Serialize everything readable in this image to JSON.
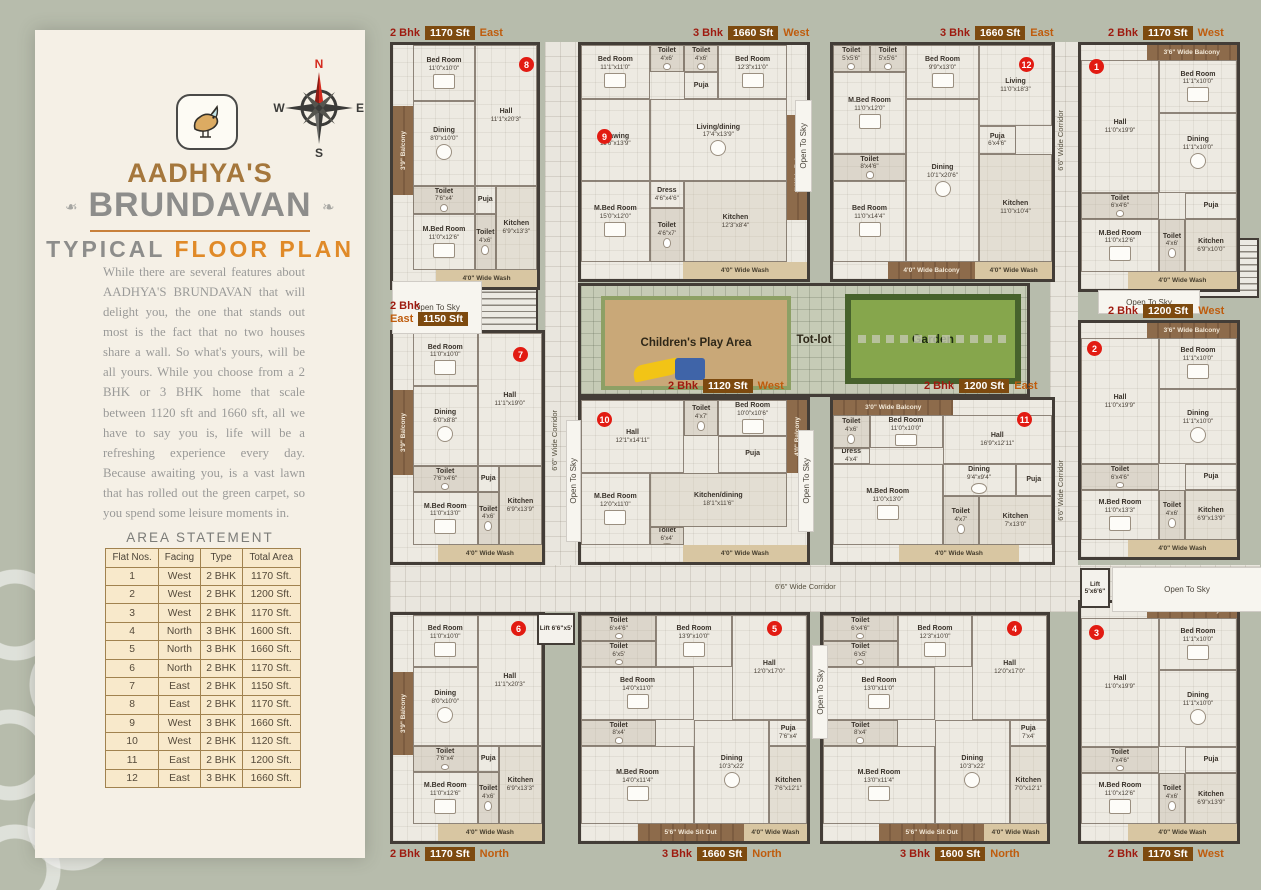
{
  "sidebar": {
    "brand_top": "AADHYA'S",
    "brand_main": "BRUNDAVAN",
    "subtitle_gray": "TYPICAL ",
    "subtitle_orange": "FLOOR PLAN",
    "paragraph": "While there are several features about AADHYA'S BRUNDAVAN that will delight you, the one that stands out most is the fact that no two houses share a wall. So what's yours, will be all yours. While you choose from a 2 BHK or 3 BHK home that scale between 1120 sft and 1660 sft, all we have to say you is, life will be a refreshing experience every day. Because awaiting you, is a vast lawn that has rolled out the green carpet, so you spend some leisure moments in.",
    "compass": {
      "n": "N",
      "e": "E",
      "s": "S",
      "w": "W"
    },
    "area_statement": {
      "title": "AREA STATEMENT",
      "headers": [
        "Flat Nos.",
        "Facing",
        "Type",
        "Total Area"
      ],
      "rows": [
        [
          "1",
          "West",
          "2 BHK",
          "1170 Sft."
        ],
        [
          "2",
          "West",
          "2 BHK",
          "1200 Sft."
        ],
        [
          "3",
          "West",
          "2 BHK",
          "1170 Sft."
        ],
        [
          "4",
          "North",
          "3 BHK",
          "1600 Sft."
        ],
        [
          "5",
          "North",
          "3 BHK",
          "1660 Sft."
        ],
        [
          "6",
          "North",
          "2 BHK",
          "1170 Sft."
        ],
        [
          "7",
          "East",
          "2 BHK",
          "1150 Sft."
        ],
        [
          "8",
          "East",
          "2 BHK",
          "1170 Sft."
        ],
        [
          "9",
          "West",
          "3 BHK",
          "1660 Sft."
        ],
        [
          "10",
          "West",
          "2 BHK",
          "1120 Sft."
        ],
        [
          "11",
          "East",
          "2 BHK",
          "1200 Sft."
        ],
        [
          "12",
          "East",
          "3 BHK",
          "1660 Sft."
        ]
      ]
    }
  },
  "plan": {
    "open_to_sky": "Open To Sky",
    "corridor": "6'6\" Wide Corridor",
    "lift_a": "Lift 6'6\"x5'",
    "lift_b": "Lift 5'x6'6\"",
    "courtyard": {
      "play": "Children's Play Area",
      "totlot": "Tot-lot",
      "garden": "Garden"
    },
    "units": [
      {
        "no": "1",
        "bhk": "2 Bhk",
        "sft": "1170 Sft",
        "facing": "West",
        "rooms": [
          {
            "n": "Hall",
            "d": "11'0\"x19'9\""
          },
          {
            "n": "Bed Room",
            "d": "11'1\"x10'0\""
          },
          {
            "n": "Dining",
            "d": "11'1\"x10'0\""
          },
          {
            "n": "Toilet",
            "d": "6'x4'6\""
          },
          {
            "n": "Puja",
            "d": ""
          },
          {
            "n": "M.Bed Room",
            "d": "11'0\"x12'6\""
          },
          {
            "n": "Toilet",
            "d": "4'x6'"
          },
          {
            "n": "Kitchen",
            "d": "6'9\"x10'0\""
          }
        ],
        "strips": [
          "3'6\" Wide Balcony",
          "4'0\" Wide Wash"
        ]
      },
      {
        "no": "2",
        "bhk": "2 Bhk",
        "sft": "1200 Sft",
        "facing": "West",
        "rooms": [
          {
            "n": "Hall",
            "d": "11'0\"x19'9\""
          },
          {
            "n": "Bed Room",
            "d": "11'1\"x10'0\""
          },
          {
            "n": "Dining",
            "d": "11'1\"x10'0\""
          },
          {
            "n": "Toilet",
            "d": "6'x4'6\""
          },
          {
            "n": "Puja",
            "d": ""
          },
          {
            "n": "M.Bed Room",
            "d": "11'0\"x13'3\""
          },
          {
            "n": "Toilet",
            "d": "4'x6'"
          },
          {
            "n": "Kitchen",
            "d": "6'9\"x13'9\""
          }
        ],
        "strips": [
          "3'6\" Wide Balcony",
          "4'0\" Wide Wash"
        ]
      },
      {
        "no": "3",
        "bhk": "2 Bhk",
        "sft": "1170 Sft",
        "facing": "West",
        "rooms": [
          {
            "n": "Hall",
            "d": "11'0\"x19'9\""
          },
          {
            "n": "Bed Room",
            "d": "11'1\"x10'0\""
          },
          {
            "n": "Dining",
            "d": "11'1\"x10'0\""
          },
          {
            "n": "Toilet",
            "d": "7'x4'6\""
          },
          {
            "n": "Puja",
            "d": ""
          },
          {
            "n": "M.Bed Room",
            "d": "11'0\"x12'6\""
          },
          {
            "n": "Toilet",
            "d": "4'x6'"
          },
          {
            "n": "Kitchen",
            "d": "6'9\"x13'9\""
          }
        ],
        "strips": [
          "3'6\" Wide Balcony",
          "4'0\" Wide Wash"
        ]
      },
      {
        "no": "4",
        "bhk": "3 Bhk",
        "sft": "1600 Sft",
        "facing": "North",
        "rooms": [
          {
            "n": "Toilet",
            "d": "6'x4'6\""
          },
          {
            "n": "Bed Room",
            "d": "12'3\"x10'0\""
          },
          {
            "n": "Toilet",
            "d": "6'x5'"
          },
          {
            "n": "Bed Room",
            "d": "13'0\"x11'0\""
          },
          {
            "n": "Hall",
            "d": "12'0\"x17'0\""
          },
          {
            "n": "Toilet",
            "d": "8'x4'"
          },
          {
            "n": "M.Bed Room",
            "d": "13'0\"x11'4\""
          },
          {
            "n": "Dining",
            "d": "10'3\"x22'"
          },
          {
            "n": "Puja",
            "d": "7'x4'"
          },
          {
            "n": "Kitchen",
            "d": "7'0\"x12'1\""
          }
        ],
        "strips": [
          "5'6\" Wide Sit Out",
          "4'0\" Wide Wash"
        ]
      },
      {
        "no": "5",
        "bhk": "3 Bhk",
        "sft": "1660 Sft",
        "facing": "North",
        "rooms": [
          {
            "n": "Toilet",
            "d": "6'x4'6\""
          },
          {
            "n": "Toilet",
            "d": "6'x5'"
          },
          {
            "n": "Bed Room",
            "d": "13'9\"x10'0\""
          },
          {
            "n": "Hall",
            "d": "12'0\"x17'0\""
          },
          {
            "n": "Bed Room",
            "d": "14'0\"x11'0\""
          },
          {
            "n": "Toilet",
            "d": "8'x4'"
          },
          {
            "n": "M.Bed Room",
            "d": "14'0\"x11'4\""
          },
          {
            "n": "Dining",
            "d": "10'3\"x22'"
          },
          {
            "n": "Puja",
            "d": "7'6\"x4'"
          },
          {
            "n": "Kitchen",
            "d": "7'6\"x12'1\""
          }
        ],
        "strips": [
          "5'6\" Wide Sit Out",
          "4'0\" Wide Wash"
        ]
      },
      {
        "no": "6",
        "bhk": "2 Bhk",
        "sft": "1170 Sft",
        "facing": "North",
        "rooms": [
          {
            "n": "Bed Room",
            "d": "11'0\"x10'0\""
          },
          {
            "n": "Hall",
            "d": "11'1\"x20'3\""
          },
          {
            "n": "Dining",
            "d": "8'0\"x10'0\""
          },
          {
            "n": "Toilet",
            "d": "7'6\"x4'"
          },
          {
            "n": "M.Bed Room",
            "d": "11'0\"x12'6\""
          },
          {
            "n": "Puja",
            "d": ""
          },
          {
            "n": "Toilet",
            "d": "4'x6'"
          },
          {
            "n": "Kitchen",
            "d": "6'9\"x13'3\""
          }
        ],
        "strips": [
          "3'9\" Balcony",
          "4'0\" Wide Wash"
        ]
      },
      {
        "no": "7",
        "bhk": "2 Bhk",
        "sft": "1150 Sft",
        "facing": "East",
        "rooms": [
          {
            "n": "Bed Room",
            "d": "11'0\"x10'0\""
          },
          {
            "n": "Hall",
            "d": "11'1\"x19'0\""
          },
          {
            "n": "Dining",
            "d": "6'0\"x8'8\""
          },
          {
            "n": "Toilet",
            "d": "7'6\"x4'6\""
          },
          {
            "n": "M.Bed Room",
            "d": "11'0\"x13'0\""
          },
          {
            "n": "Puja",
            "d": ""
          },
          {
            "n": "Toilet",
            "d": "4'x6'"
          },
          {
            "n": "Kitchen",
            "d": "6'9\"x13'9\""
          }
        ],
        "strips": [
          "3'9\" Balcony",
          "4'0\" Wide Wash"
        ]
      },
      {
        "no": "8",
        "bhk": "2 Bhk",
        "sft": "1170 Sft",
        "facing": "East",
        "rooms": [
          {
            "n": "Bed Room",
            "d": "11'0\"x10'0\""
          },
          {
            "n": "Hall",
            "d": "11'1\"x20'3\""
          },
          {
            "n": "Dining",
            "d": "8'0\"x10'0\""
          },
          {
            "n": "Toilet",
            "d": "7'6\"x4'"
          },
          {
            "n": "M.Bed Room",
            "d": "11'0\"x12'6\""
          },
          {
            "n": "Puja",
            "d": ""
          },
          {
            "n": "Toilet",
            "d": "4'x6'"
          },
          {
            "n": "Kitchen",
            "d": "6'9\"x13'3\""
          }
        ],
        "strips": [
          "3'9\" Balcony",
          "4'0\" Wide Wash"
        ]
      },
      {
        "no": "9",
        "bhk": "3 Bhk",
        "sft": "1660 Sft",
        "facing": "West",
        "rooms": [
          {
            "n": "Bed Room",
            "d": "11'1\"x11'0\""
          },
          {
            "n": "Toilet",
            "d": "4'x6'"
          },
          {
            "n": "Toilet",
            "d": "4'x6'"
          },
          {
            "n": "Bed Room",
            "d": "12'3\"x11'0\""
          },
          {
            "n": "Drawing",
            "d": "11'6\"x13'9\""
          },
          {
            "n": "Living/dining",
            "d": "17'4\"x13'9\""
          },
          {
            "n": "Puja",
            "d": ""
          },
          {
            "n": "M.Bed Room",
            "d": "15'0\"x12'0\""
          },
          {
            "n": "Dress",
            "d": "4'6\"x4'6\""
          },
          {
            "n": "Toilet",
            "d": "4'6\"x7'"
          },
          {
            "n": "Kitchen",
            "d": "12'3\"x8'4\""
          }
        ],
        "strips": [
          "4' Wide Balcony",
          "4'0\" Wide Wash"
        ]
      },
      {
        "no": "10",
        "bhk": "2 Bhk",
        "sft": "1120 Sft",
        "facing": "West",
        "rooms": [
          {
            "n": "Hall",
            "d": "12'1\"x14'11\""
          },
          {
            "n": "Toilet",
            "d": "4'x7'"
          },
          {
            "n": "Bed Room",
            "d": "10'0\"x10'6\""
          },
          {
            "n": "Puja",
            "d": ""
          },
          {
            "n": "M.Bed Room",
            "d": "12'0\"x11'0\""
          },
          {
            "n": "Kitchen/dining",
            "d": "18'1\"x11'6\""
          },
          {
            "n": "Toilet",
            "d": "6'x4'"
          }
        ],
        "strips": [
          "4'0\" Balcony",
          "4'0\" Wide Wash"
        ]
      },
      {
        "no": "11",
        "bhk": "2 Bhk",
        "sft": "1200 Sft",
        "facing": "East",
        "rooms": [
          {
            "n": "Toilet",
            "d": "4'x6'"
          },
          {
            "n": "Bed Room",
            "d": "11'0\"x10'0\""
          },
          {
            "n": "Hall",
            "d": "16'9\"x12'11\""
          },
          {
            "n": "Dress",
            "d": "4'x4'"
          },
          {
            "n": "M.Bed Room",
            "d": "11'0\"x13'0\""
          },
          {
            "n": "Dining",
            "d": "9'4\"x9'4\""
          },
          {
            "n": "Puja",
            "d": ""
          },
          {
            "n": "Toilet",
            "d": "4'x7'"
          },
          {
            "n": "Kitchen",
            "d": "7'x13'0\""
          }
        ],
        "strips": [
          "3'0\" Wide Balcony",
          "4'0\" Wide Wash"
        ]
      },
      {
        "no": "12",
        "bhk": "3 Bhk",
        "sft": "1660 Sft",
        "facing": "East",
        "rooms": [
          {
            "n": "Toilet",
            "d": "5'x5'6\""
          },
          {
            "n": "Toilet",
            "d": "5'x5'6\""
          },
          {
            "n": "Bed Room",
            "d": "9'9\"x13'0\""
          },
          {
            "n": "Living",
            "d": "11'0\"x18'3\""
          },
          {
            "n": "M.Bed Room",
            "d": "11'0\"x12'0\""
          },
          {
            "n": "Toilet",
            "d": "8'x4'6\""
          },
          {
            "n": "Bed Room",
            "d": "11'0\"x14'4\""
          },
          {
            "n": "Dining",
            "d": "10'1\"x20'6\""
          },
          {
            "n": "Puja",
            "d": "6'x4'6\""
          },
          {
            "n": "Kitchen",
            "d": "11'0\"x10'4\""
          }
        ],
        "strips": [
          "4'0\" Wide Balcony",
          "4'0\" Wide Wash"
        ]
      }
    ]
  }
}
